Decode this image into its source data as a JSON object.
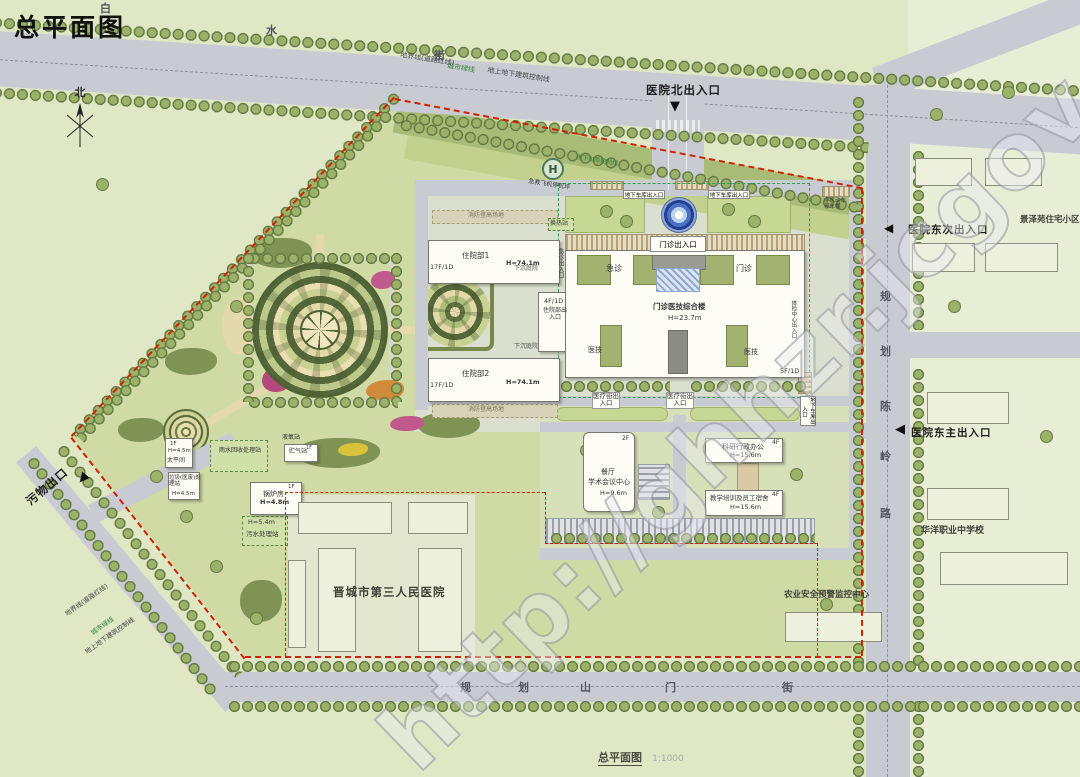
{
  "title": "总平面图",
  "caption": {
    "name": "总平面图",
    "scale": "1:1000"
  },
  "watermark": "http://ghhzr.jcgov.gov.cn/",
  "compass": {
    "north": "北"
  },
  "streets": {
    "top": [
      "白",
      "水",
      "街"
    ],
    "bottom": [
      "规",
      "划",
      "山",
      "门",
      "街"
    ],
    "right": [
      "规",
      "划",
      "陈",
      "岭",
      "路"
    ]
  },
  "entrances": {
    "north": "医院北出入口",
    "east_secondary": "医院东次出入口",
    "east_main": "医院东主出入口",
    "waste_exit": "污物出口",
    "outpatient": "门诊出入口",
    "emergency": "急诊出入口",
    "inpatient": "住院部出入口",
    "medical_street": "医疗街出入口",
    "garage": "地下车库出入口",
    "physical_exam": "体检中心出入口"
  },
  "lines": {
    "parcel": "地界线(道路红线)",
    "green": "城市绿线",
    "building_control": "地上地下建筑控制线",
    "garage_control": "地下车库控制线"
  },
  "buildings": {
    "main_complex": {
      "name": "门诊医技综合楼",
      "height": "H=23.7m",
      "floors": "5F/1D",
      "emergency": "急诊",
      "outpatient": "门诊",
      "medtech": "医技"
    },
    "inpatient1": {
      "name": "住院部1",
      "height": "H=74.1m",
      "floors": "17F/1D"
    },
    "inpatient2": {
      "name": "住院部2",
      "height": "H=74.1m",
      "floors": "17F/1D"
    },
    "inpatient_link": {
      "floors": "4F/1D"
    },
    "canteen": {
      "name1": "餐厅",
      "name2": "学术会议中心",
      "height": "H=9.6m",
      "floors": "2F"
    },
    "research": {
      "name": "科研行政办公",
      "height": "H=15.6m",
      "floors": "4F"
    },
    "dormitory": {
      "name": "教学培训及员工宿舍",
      "height": "H=15.6m",
      "floors": "4F"
    },
    "mortuary": {
      "name": "太平间",
      "height": "H=4.5m",
      "floors": "1F"
    },
    "waste_station": {
      "name": "垃圾(医废)处理站",
      "height": "H=4.5m"
    },
    "rainwater": {
      "name": "雨水回收处理站"
    },
    "oxygen": {
      "name": "液氧站"
    },
    "gas": {
      "name": "贮气站",
      "floors": "1F"
    },
    "boiler": {
      "name": "锅炉房",
      "height": "H=4.8m",
      "floors": "1F"
    },
    "sewage": {
      "name": "污水处理站",
      "height": "H=5.4m"
    },
    "heat_station": {
      "name": "换热站"
    }
  },
  "facilities": {
    "helipad_letter": "H",
    "helipad": "急救飞机停机坪",
    "fire_lane": "消防登高场地",
    "sunken_courtyard": "下沉庭院",
    "bike_shed": "非机动车停车棚"
  },
  "places": {
    "third_hospital": "晋城市第三人民医院",
    "agri_center": "农业安全预警监控中心",
    "jingzeyuan": "景泽苑住宅小区",
    "huayang_school": "华洋职业中学校"
  },
  "colors": {
    "boundary_red": "#d02100",
    "road_gray": "#c9cbd3",
    "site_green": "#cfdaa5",
    "tree_green": "#8fa463",
    "building_white": "#fdfdf6",
    "water_blue": "#2a4fae"
  }
}
